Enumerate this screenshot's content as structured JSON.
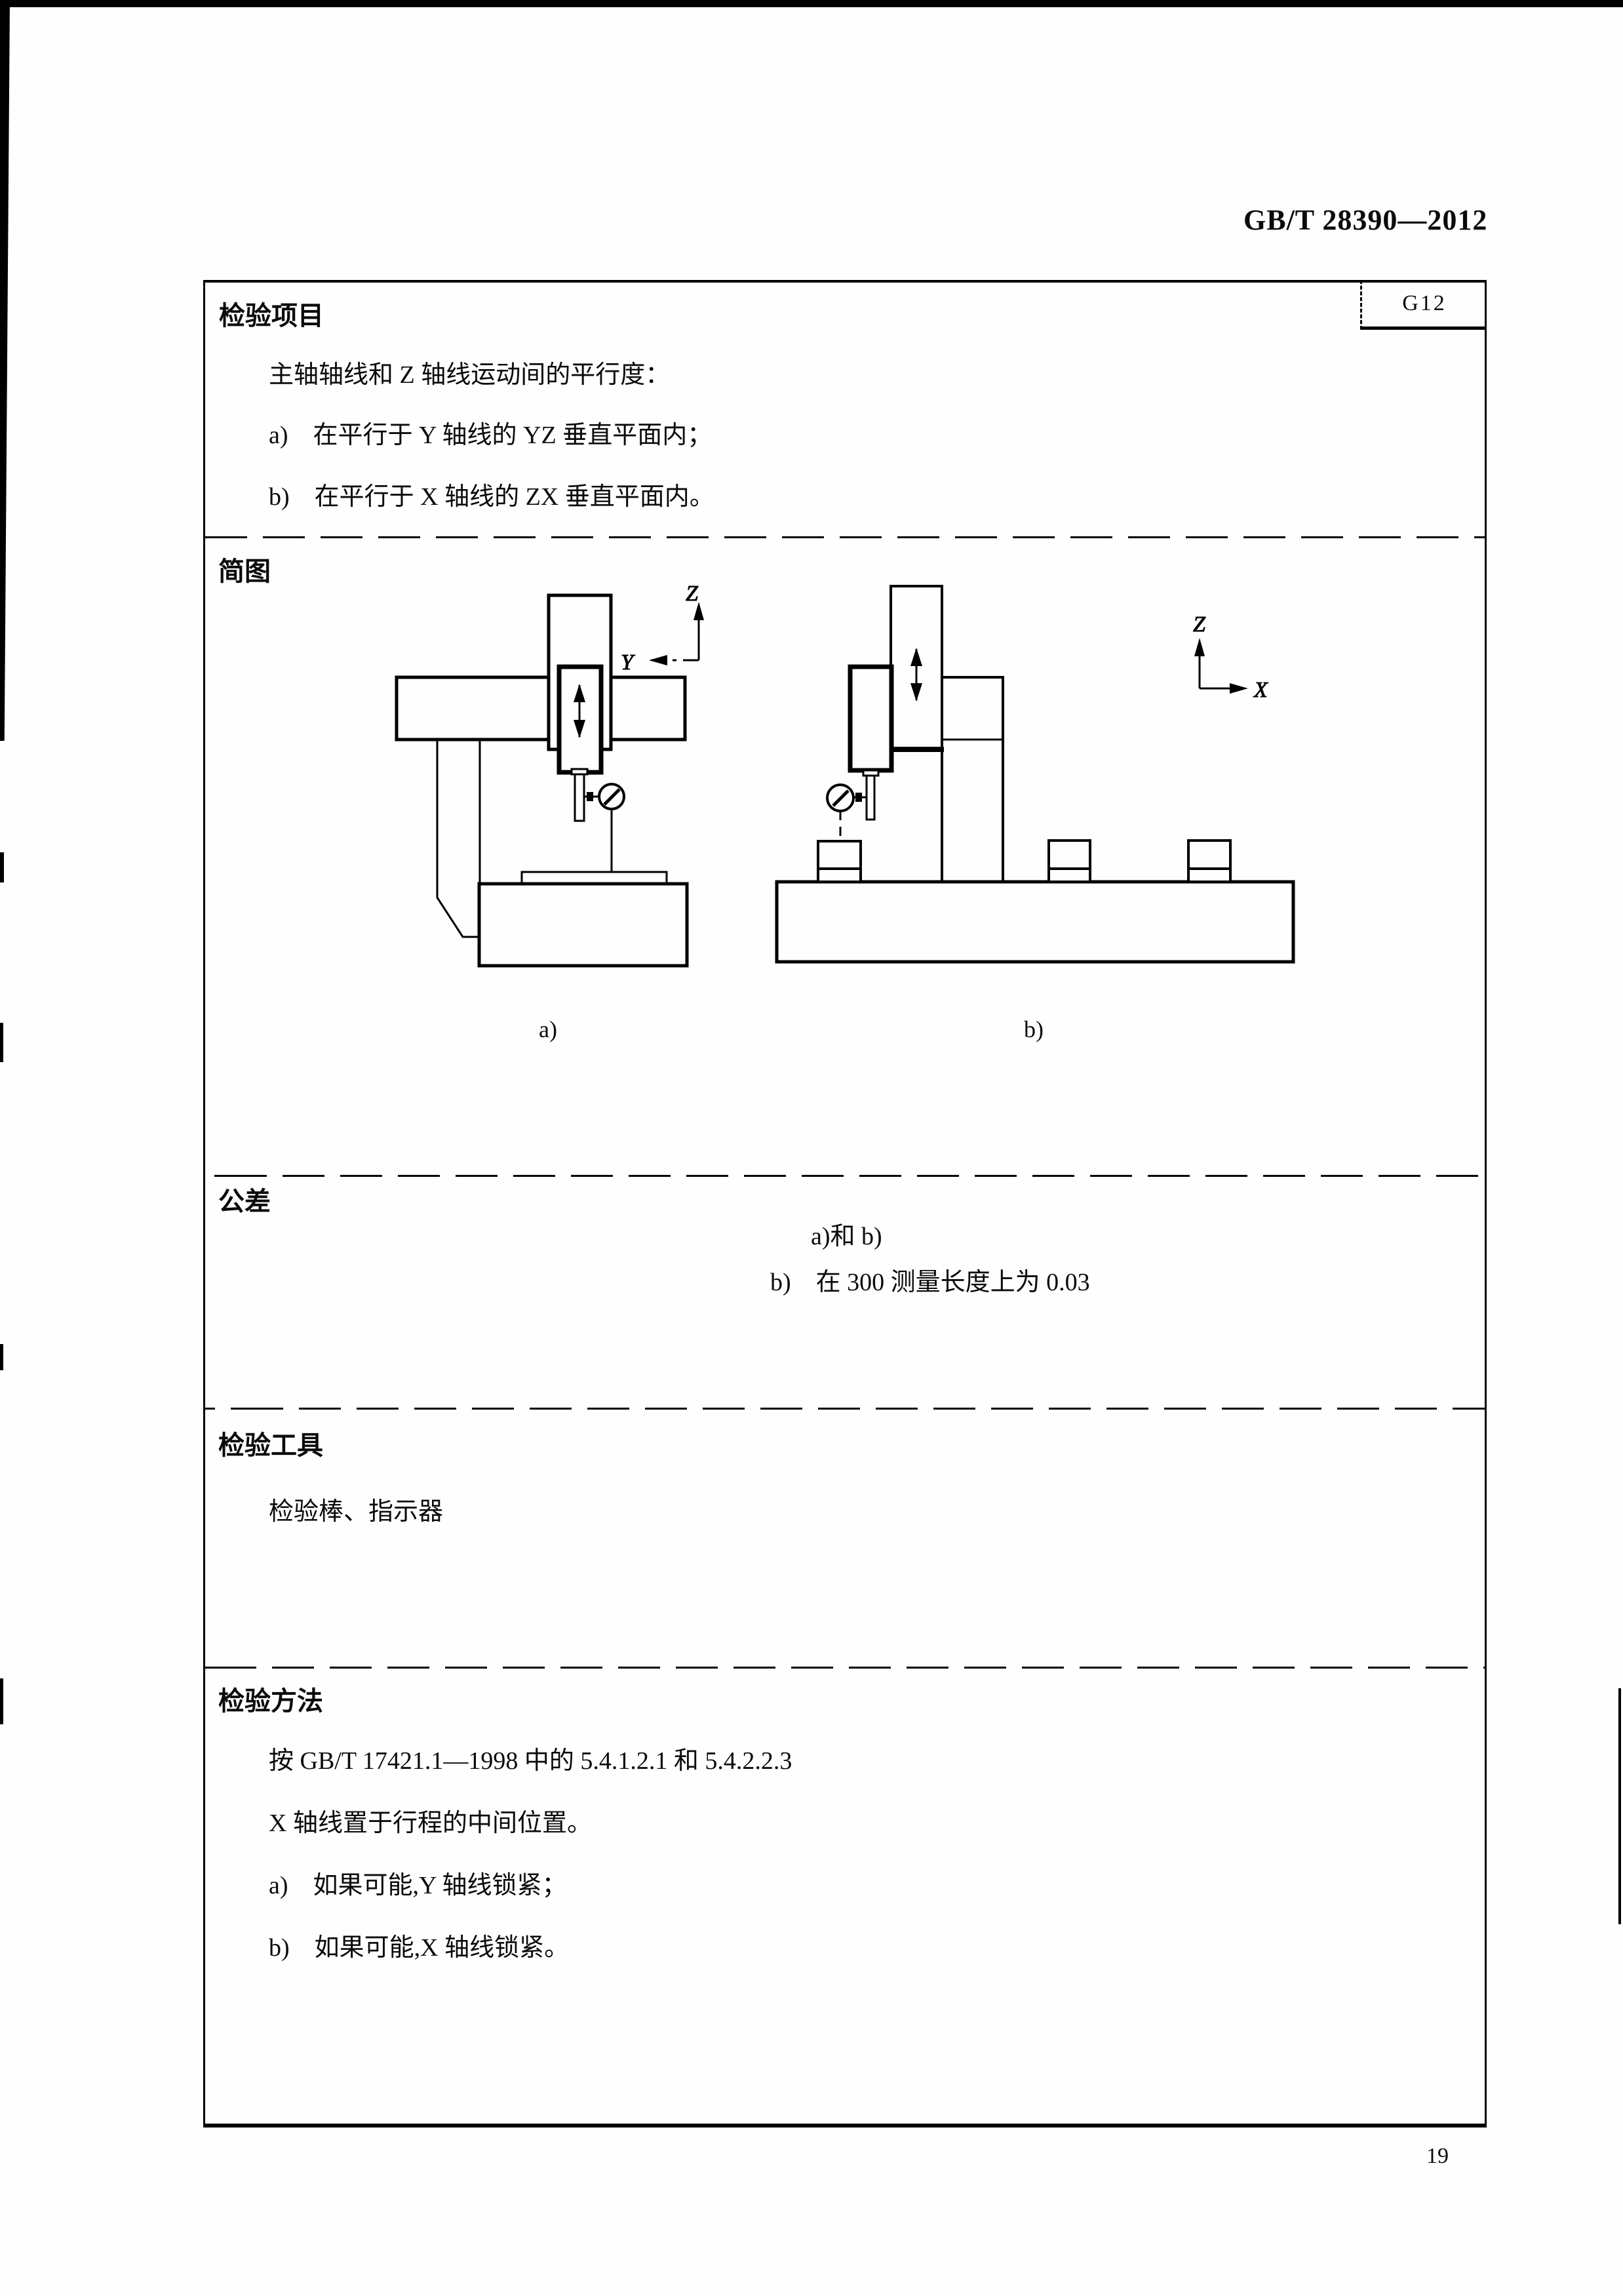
{
  "page": {
    "header": "GB/T 28390—2012",
    "page_number": "19"
  },
  "table": {
    "badge": "G12",
    "item": {
      "label": "检验项目",
      "line1": "主轴轴线和 Z 轴线运动间的平行度：",
      "line2": "a)　在平行于 Y 轴线的 YZ 垂直平面内；",
      "line3": "b)　在平行于 X 轴线的 ZX 垂直平面内。"
    },
    "diagram": {
      "label": "简图",
      "label_a": "a)",
      "label_b": "b)",
      "axis_z": "Z",
      "axis_y": "Y",
      "axis_x": "X"
    },
    "tolerance": {
      "label": "公差",
      "line1": "a)和 b)",
      "line2": "b)　在 300 测量长度上为 0.03"
    },
    "tools": {
      "label": "检验工具",
      "line1": "检验棒、指示器"
    },
    "method": {
      "label": "检验方法",
      "line1": "按 GB/T 17421.1—1998 中的 5.4.1.2.1 和 5.4.2.2.3",
      "line2": "X 轴线置于行程的中间位置。",
      "line3": "a)　如果可能,Y 轴线锁紧；",
      "line4": "b)　如果可能,X 轴线锁紧。"
    }
  }
}
